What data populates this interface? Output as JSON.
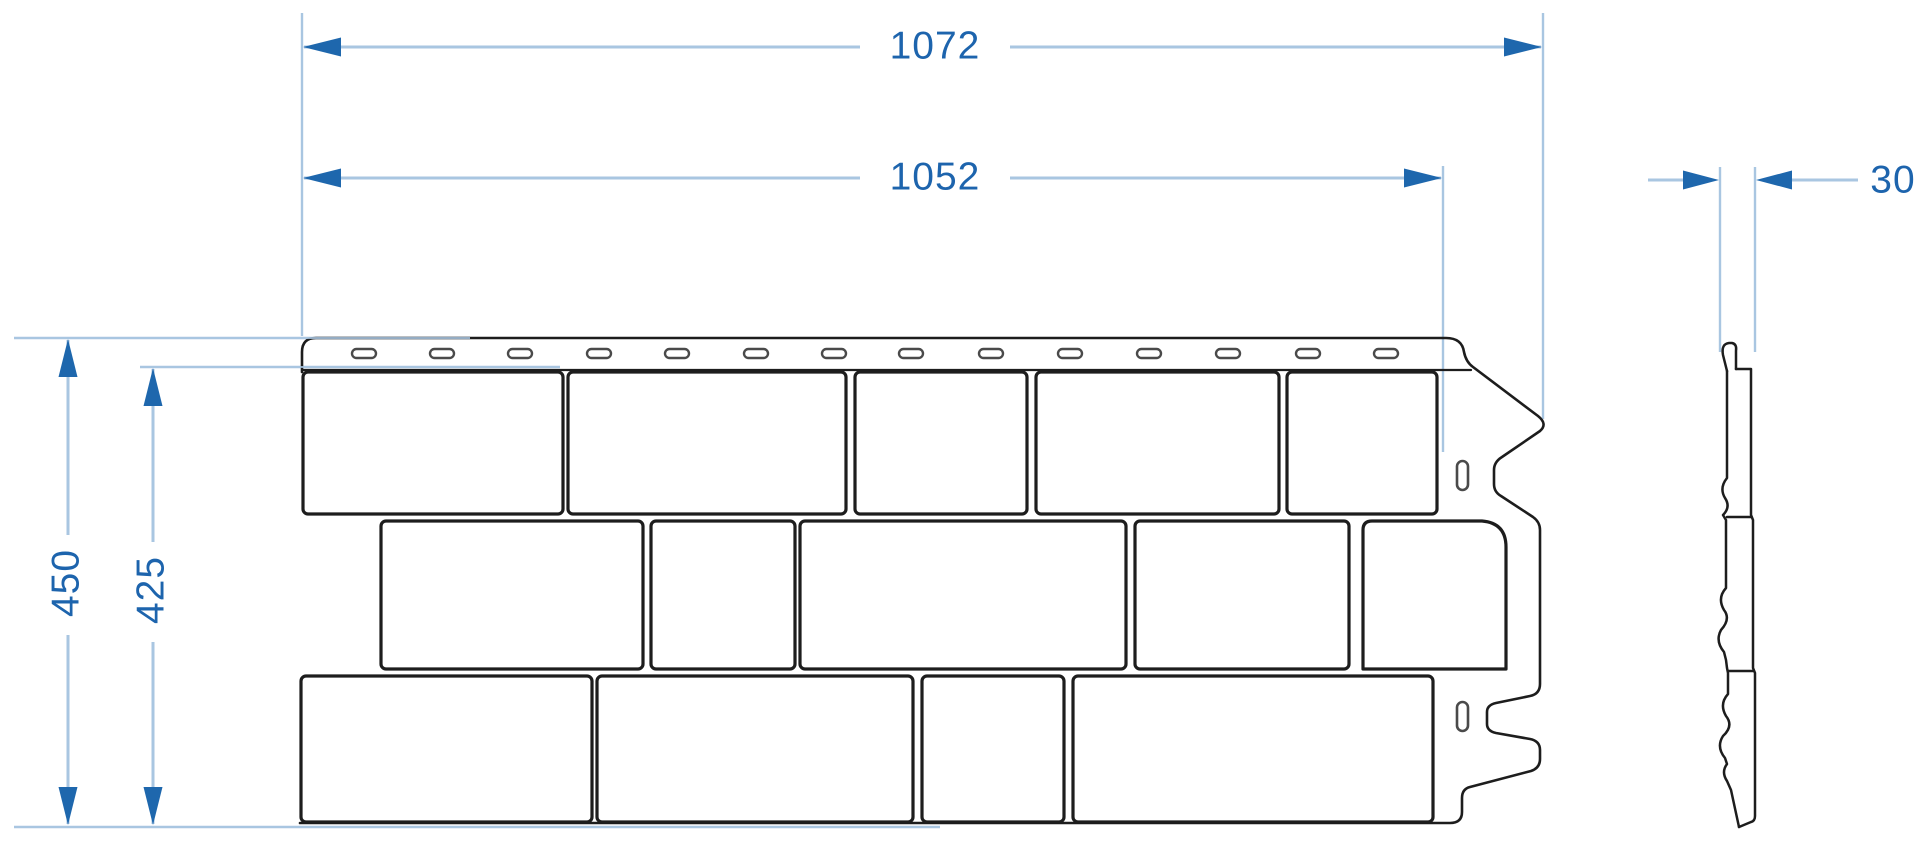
{
  "drawing": {
    "kind": "technical-dimension-drawing",
    "subject": "facade-panel-front-and-side-view",
    "dimensions": {
      "overall_width": "1072",
      "panel_width": "1052",
      "overall_height": "450",
      "panel_height": "425",
      "thickness": "30"
    },
    "colors": {
      "dimension_line": "#a9c6e1",
      "dimension_arrow": "#1e67ad",
      "dimension_text": "#1d64ad",
      "outline": "#1d1d1d",
      "slot_outline": "#4a4a4a",
      "background": "#ffffff"
    }
  }
}
